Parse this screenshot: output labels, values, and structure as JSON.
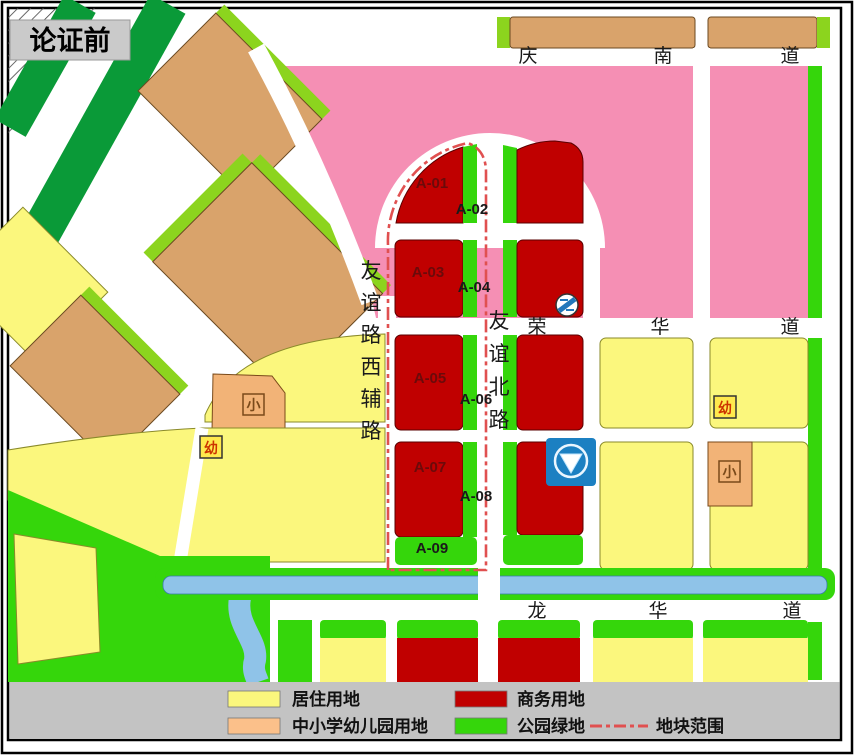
{
  "title": "论证前",
  "roads": {
    "qingnan": {
      "name": "庆南道",
      "chars": [
        "庆",
        "南",
        "道"
      ]
    },
    "ronghua": {
      "name": "荣华道",
      "chars": [
        "荣",
        "华",
        "道"
      ]
    },
    "longhua": {
      "name": "龙华道",
      "chars": [
        "龙",
        "华",
        "道"
      ]
    },
    "youyi_west_aux": {
      "name": "友谊路西辅路",
      "chars": [
        "友",
        "谊",
        "路",
        "西",
        "辅",
        "路"
      ]
    },
    "youyi_north": {
      "name": "友谊北路",
      "chars": [
        "友",
        "谊",
        "北",
        "路"
      ]
    }
  },
  "plots": {
    "labels": [
      "A-01",
      "A-02",
      "A-03",
      "A-04",
      "A-05",
      "A-06",
      "A-07",
      "A-08",
      "A-09"
    ]
  },
  "markers": {
    "primary_school": "小",
    "kindergarten": "幼"
  },
  "icons": {
    "station": "metro-station-icon",
    "crossing": "road-crossing-badge-icon"
  },
  "legend": {
    "residential": "居住用地",
    "school": "中小学幼儿园用地",
    "business": "商务用地",
    "park": "公园绿地",
    "boundary": "地块范围"
  },
  "colors": {
    "residential": "#FBF77D",
    "school": "#F2B377",
    "legendschool": "#FBC08A",
    "business": "#C00000",
    "park": "#35D60B",
    "parkdark": "#0A9A38",
    "striplight": "#8CD41E",
    "pink": "#F58FB4",
    "river": "#8FC3E8",
    "tan": "#D9A36B",
    "boundary": "#E05050",
    "legendbg": "#C3C3C3",
    "titlebg": "#CACACA",
    "metroblue": "#1C80C2",
    "markerred": "#CC3300",
    "markerbrown": "#7A4A1A"
  }
}
